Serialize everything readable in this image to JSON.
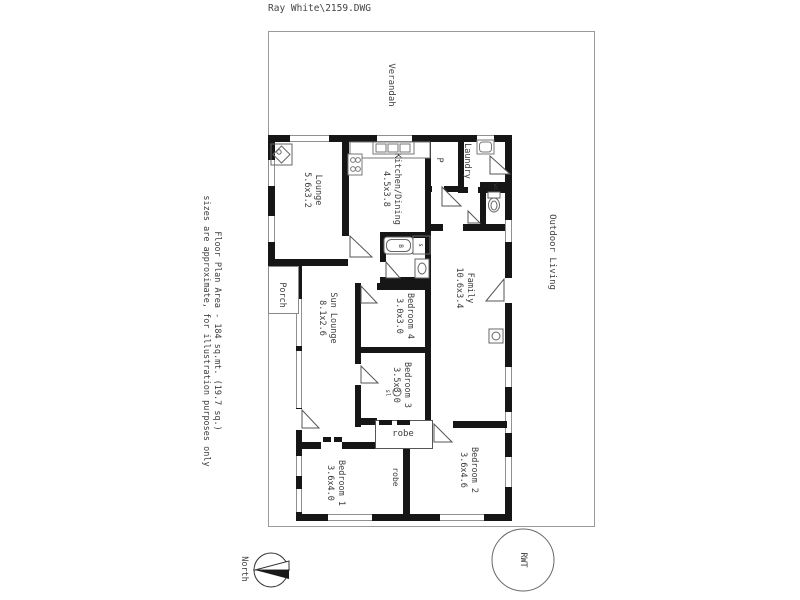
{
  "header": {
    "filename": "Ray White\\2159.DWG"
  },
  "disclaimer": {
    "line1": "Floor Plan Area - 184 sq.mt. (19.7 sq.)",
    "line2": "sizes are approximate, for illustration purposes only"
  },
  "areas": {
    "verandah": "Verandah",
    "outdoor_living": "Outdoor Living",
    "porch": "Porch"
  },
  "rooms": {
    "lounge": {
      "name": "Lounge",
      "size": "5.6x3.2"
    },
    "kitchen": {
      "name": "Kitchen/Dining",
      "size": "4.5x3.8"
    },
    "pantry": {
      "name": "P"
    },
    "laundry": {
      "name": "Laundry"
    },
    "wc": {
      "name": "wc"
    },
    "family": {
      "name": "Family",
      "size": "10.6x3.4"
    },
    "sun_lounge": {
      "name": "Sun Lounge",
      "size": "8.1x2.6"
    },
    "bedroom4": {
      "name": "Bedroom 4",
      "size": "3.0x3.0"
    },
    "bedroom3": {
      "name": "Bedroom 3",
      "size": "3.5x3.0",
      "note": "sl"
    },
    "bedroom1": {
      "name": "Bedroom 1",
      "size": "3.6x4.0"
    },
    "bedroom2": {
      "name": "Bedroom 2",
      "size": "3.6x4.6"
    },
    "robe_rear": {
      "name": "robe"
    },
    "robe_front": {
      "name": "robe"
    }
  },
  "fixtures": {
    "bath": "B",
    "shower": "s"
  },
  "compass": {
    "label": "North"
  },
  "tank": {
    "label": "RWT"
  },
  "icons": [
    "fireplace-icon",
    "stove-icon",
    "kitchen-sink-icon",
    "laundry-trough-icon",
    "toilet-icon",
    "bathtub-icon",
    "shower-icon",
    "vanity-icon",
    "heater-icon",
    "ceiling-light-icon",
    "north-arrow-icon",
    "water-tank-icon",
    "door-swing-icon"
  ],
  "colors": {
    "wall": "#161616",
    "thin_line": "#9a9a9a",
    "text": "#3c3c3c",
    "background": "#ffffff"
  }
}
